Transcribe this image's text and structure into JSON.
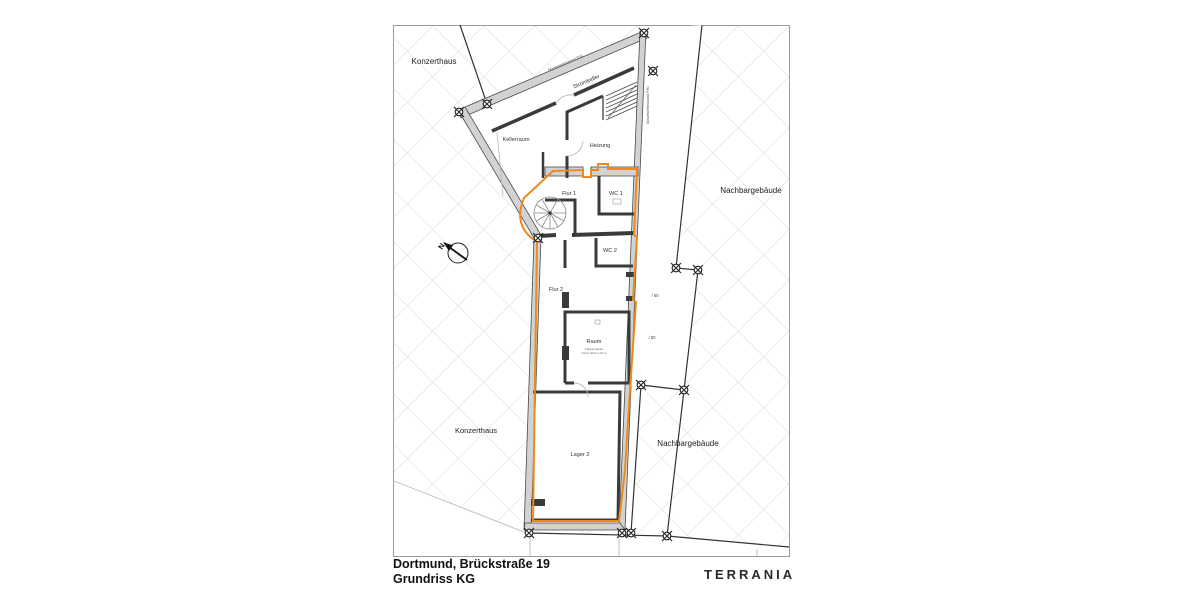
{
  "title_block": {
    "address": "Dortmund, Brückstraße 19",
    "drawing_title": "Grundriss KG"
  },
  "brand": {
    "name": "TERRANIA"
  },
  "site_labels": {
    "konzerthaus_top": "Konzerthaus",
    "konzerthaus_bottom": "Konzerthaus",
    "nachbargebaeude_top": "Nachbargebäude",
    "nachbargebaeude_bottom": "Nachbargebäude"
  },
  "plan": {
    "north_label": "N",
    "rooms": {
      "kellerraum": "Kellerraum",
      "stromkeller": "Stromkeller",
      "heizung": "Heizung",
      "flur1": "Flur 1",
      "wc1": "WC 1",
      "wc2": "WC 2",
      "flur2": "Flur 2",
      "raum": "Raum",
      "lager2": "Lager 2"
    },
    "raum_caption_line1": "Kappendecke",
    "raum_caption_line2": "lichte Höhe 2,31 m",
    "wall_labels": {
      "top": "Mauerwerkswand F90",
      "right": "Mauerwerkswand F90"
    },
    "annotations": {
      "dim_upper": "/ 60",
      "dim_lower": "/ 50"
    }
  },
  "colors": {
    "unit_outline": "#ED8A1F",
    "wall_fill": "#D2D2D2",
    "line_dark": "#3A3A3A",
    "hatch": "#D9D9D9"
  }
}
